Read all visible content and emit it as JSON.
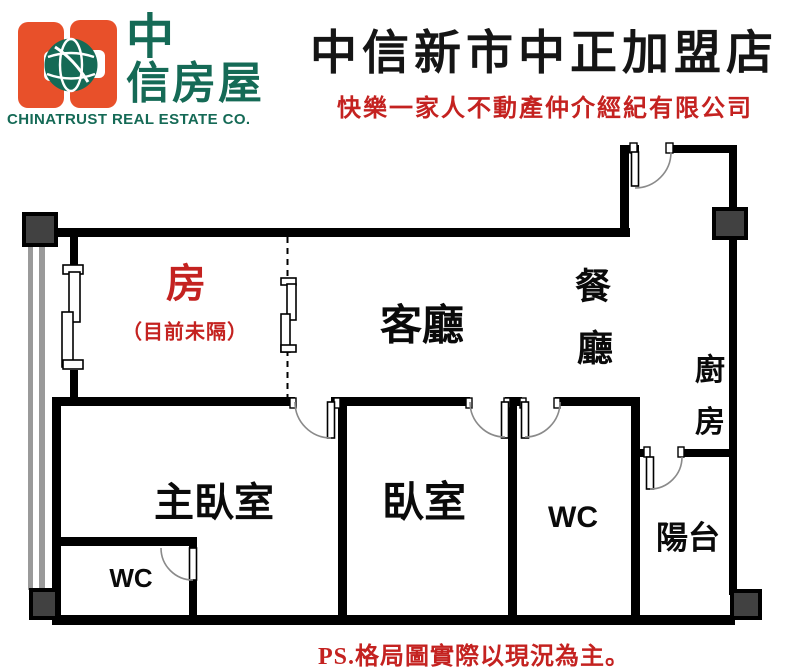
{
  "header": {
    "logo": {
      "cn_line1": "中",
      "cn_line2": "信房屋",
      "company_en": "CHINATRUST REAL ESTATE CO.",
      "brand_orange": "#e8502a",
      "brand_green": "#156a56"
    },
    "store_title": "中信新市中正加盟店",
    "subtitle": "快樂一家人不動產仲介經紀有限公司",
    "title_color": "#151515",
    "subtitle_color": "#c42220"
  },
  "floorplan": {
    "wall_color": "#000000",
    "column_color": "#414141",
    "rooms": {
      "flex": {
        "label": "房",
        "note": "（目前未隔）",
        "label_color": "#c42220"
      },
      "living": {
        "label": "客廳"
      },
      "dining": {
        "char1": "餐",
        "char2": "廳"
      },
      "kitchen": {
        "char1": "廚",
        "char2": "房"
      },
      "master": {
        "label": "主臥室"
      },
      "bedroom": {
        "label": "臥室"
      },
      "wc_master": {
        "label": "WC"
      },
      "wc": {
        "label": "WC"
      },
      "balcony": {
        "label": "陽台"
      }
    }
  },
  "footer": {
    "note": "PS.格局圖實際以現況為主。",
    "color": "#c42220"
  }
}
